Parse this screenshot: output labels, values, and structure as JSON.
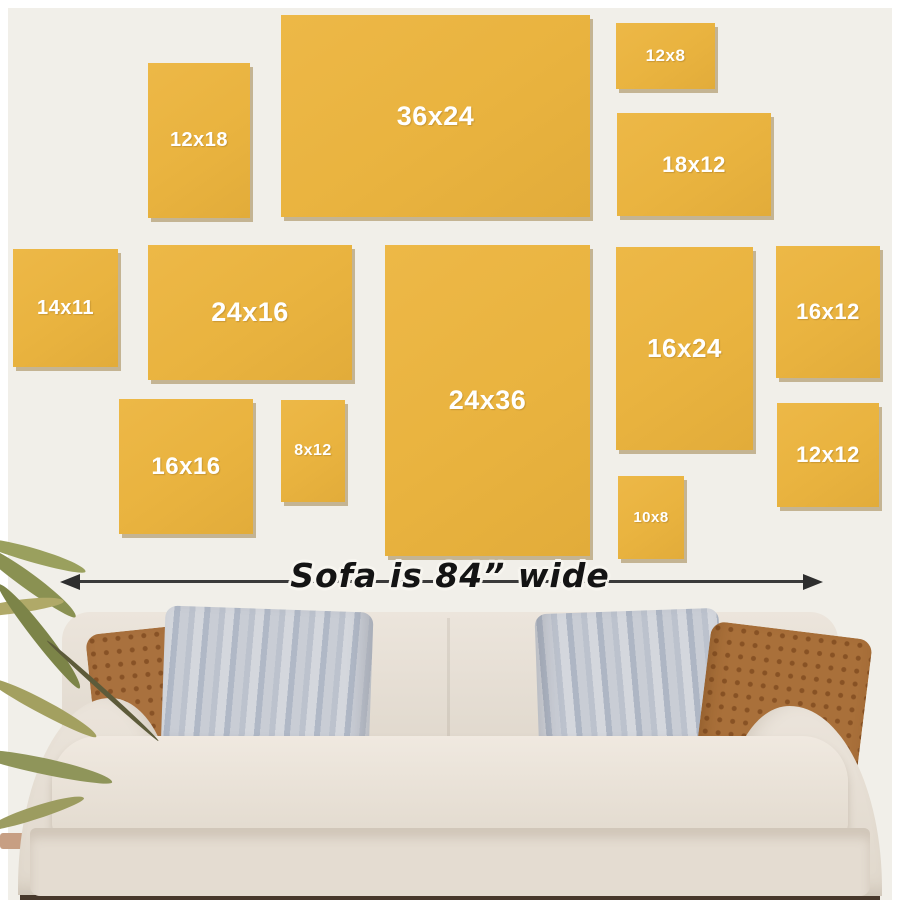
{
  "scene": {
    "description_labels": {
      "sofa_width": "Sofa is 84” wide"
    },
    "colors": {
      "wall": "#f1efe9",
      "page_border": "#ffffff",
      "frame_yellow": "#e9b43f",
      "frame_label": "#ffffff",
      "dimension_line": "#3a3a3a",
      "sofa_fabric": "#e6dfd5",
      "pillow_brown": "#a9713e",
      "pillow_gray": "#c3c8d1",
      "floor": "#47382b",
      "plant_green": "#8f955a"
    },
    "frames": [
      {
        "label": "12x18",
        "x": 148,
        "y": 63,
        "w": 102,
        "h": 155,
        "font": 20
      },
      {
        "label": "36x24",
        "x": 281,
        "y": 15,
        "w": 309,
        "h": 202,
        "font": 27
      },
      {
        "label": "12x8",
        "x": 616,
        "y": 23,
        "w": 99,
        "h": 66,
        "font": 17
      },
      {
        "label": "18x12",
        "x": 617,
        "y": 113,
        "w": 154,
        "h": 103,
        "font": 22
      },
      {
        "label": "14x11",
        "x": 13,
        "y": 249,
        "w": 105,
        "h": 118,
        "font": 20
      },
      {
        "label": "24x16",
        "x": 148,
        "y": 245,
        "w": 204,
        "h": 135,
        "font": 27
      },
      {
        "label": "24x36",
        "x": 385,
        "y": 245,
        "w": 205,
        "h": 311,
        "font": 27
      },
      {
        "label": "16x24",
        "x": 616,
        "y": 247,
        "w": 137,
        "h": 203,
        "font": 26
      },
      {
        "label": "16x12",
        "x": 776,
        "y": 246,
        "w": 104,
        "h": 132,
        "font": 22
      },
      {
        "label": "16x16",
        "x": 119,
        "y": 399,
        "w": 134,
        "h": 135,
        "font": 24
      },
      {
        "label": "8x12",
        "x": 281,
        "y": 400,
        "w": 64,
        "h": 102,
        "font": 16
      },
      {
        "label": "10x8",
        "x": 618,
        "y": 476,
        "w": 66,
        "h": 83,
        "font": 15
      },
      {
        "label": "12x12",
        "x": 777,
        "y": 403,
        "w": 102,
        "h": 104,
        "font": 22
      }
    ]
  }
}
